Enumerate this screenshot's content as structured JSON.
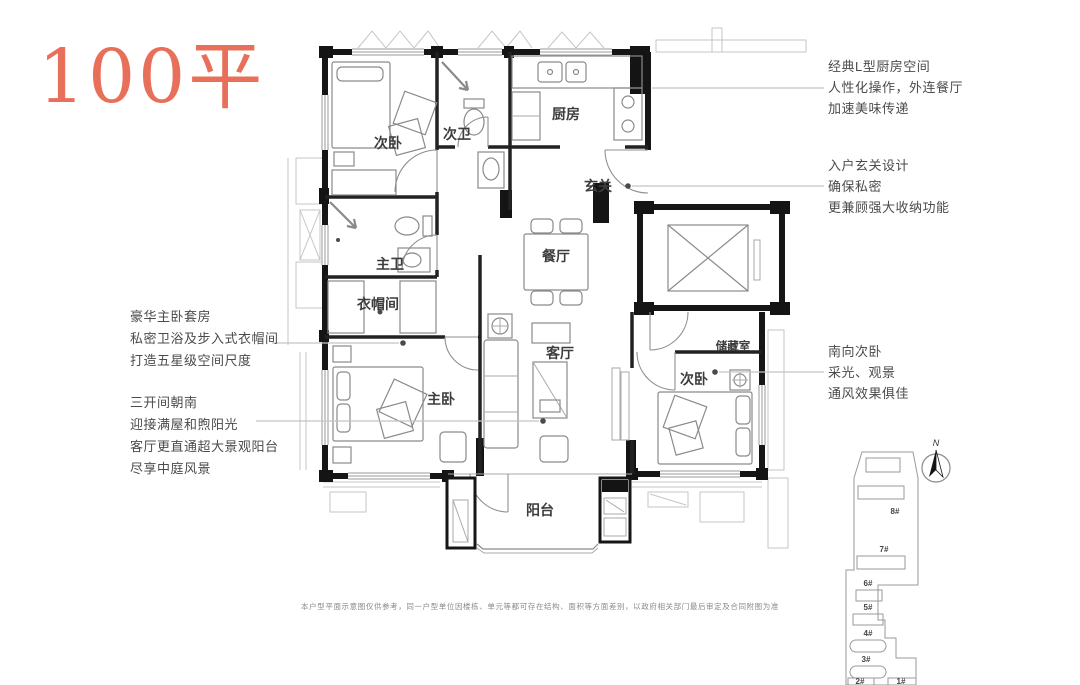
{
  "title": "100平",
  "accent_color": "#E8705A",
  "plan": {
    "rooms": [
      {
        "id": "bedroom-north",
        "label": "次卧"
      },
      {
        "id": "bath-second",
        "label": "次卫"
      },
      {
        "id": "kitchen",
        "label": "厨房"
      },
      {
        "id": "foyer",
        "label": "玄关"
      },
      {
        "id": "dining",
        "label": "餐厅"
      },
      {
        "id": "bath-master",
        "label": "主卫"
      },
      {
        "id": "cloakroom",
        "label": "衣帽间"
      },
      {
        "id": "bedroom-master",
        "label": "主卧"
      },
      {
        "id": "living",
        "label": "客厅"
      },
      {
        "id": "storage",
        "label": "储藏室"
      },
      {
        "id": "bedroom-south",
        "label": "次卧"
      },
      {
        "id": "balcony",
        "label": "阳台"
      }
    ]
  },
  "annotations": {
    "left": [
      {
        "lines": [
          "豪华主卧套房",
          "私密卫浴及步入式衣帽间",
          "打造五星级空间尺度"
        ]
      },
      {
        "lines": [
          "三开间朝南",
          "迎接满屋和煦阳光",
          "客厅更直通超大景观阳台",
          "尽享中庭风景"
        ]
      }
    ],
    "right": [
      {
        "lines": [
          "经典L型厨房空间",
          "人性化操作，外连餐厅",
          "加速美味传递"
        ]
      },
      {
        "lines": [
          "入户玄关设计",
          "确保私密",
          "更兼顾强大收纳功能"
        ]
      },
      {
        "lines": [
          "南向次卧",
          "采光、观景",
          "通风效果俱佳"
        ]
      }
    ]
  },
  "site_plan": {
    "compass_label": "N",
    "buildings": [
      "8#",
      "7#",
      "6#",
      "5#",
      "4#",
      "3#",
      "2#",
      "1#"
    ]
  },
  "disclaimer": "本户型平面示意图仅供参考，同一户型单位因楼栋、单元等都可存在结构、面积等方面差别，以政府相关部门最后审定及合同附图为准"
}
